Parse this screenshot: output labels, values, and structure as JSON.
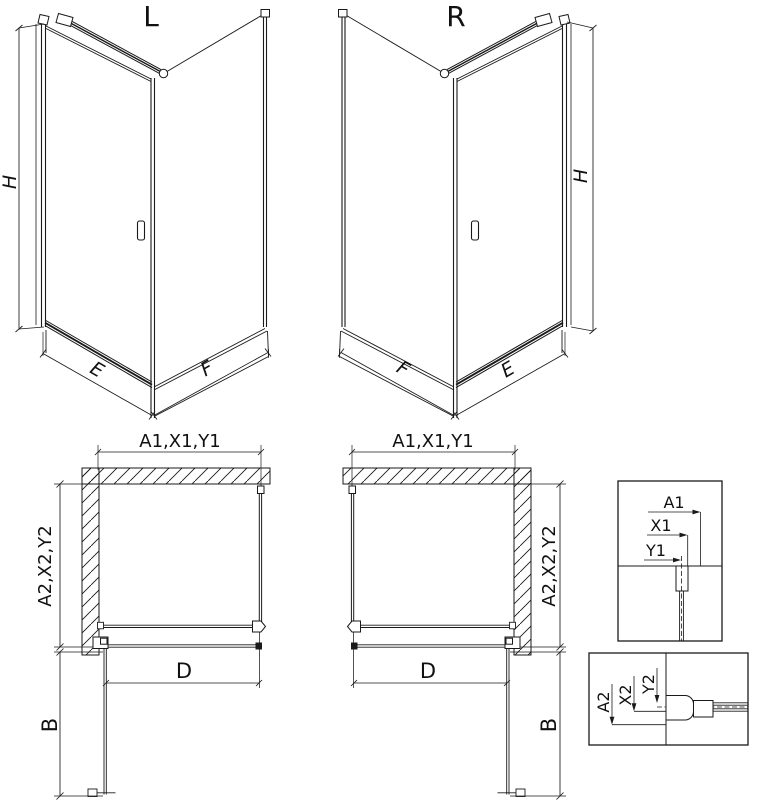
{
  "colors": {
    "line": "#1a1a1a",
    "background": "#ffffff"
  },
  "views": {
    "left_3d": {
      "name_label": "L",
      "height_dim": "H",
      "front_dim": "E",
      "side_dim": "F"
    },
    "right_3d": {
      "name_label": "R",
      "height_dim": "H",
      "front_dim": "E",
      "side_dim": "F"
    },
    "left_plan": {
      "width_dim": "A1,X1,Y1",
      "depth_dim": "A2,X2,Y2",
      "door_dim": "D",
      "swing_dim": "B"
    },
    "right_plan": {
      "width_dim": "A1,X1,Y1",
      "depth_dim": "A2,X2,Y2",
      "door_dim": "D",
      "swing_dim": "B"
    },
    "detail_width": {
      "a": "A1",
      "x": "X1",
      "y": "Y1"
    },
    "detail_depth": {
      "a": "A2",
      "x": "X2",
      "y": "Y2"
    }
  }
}
